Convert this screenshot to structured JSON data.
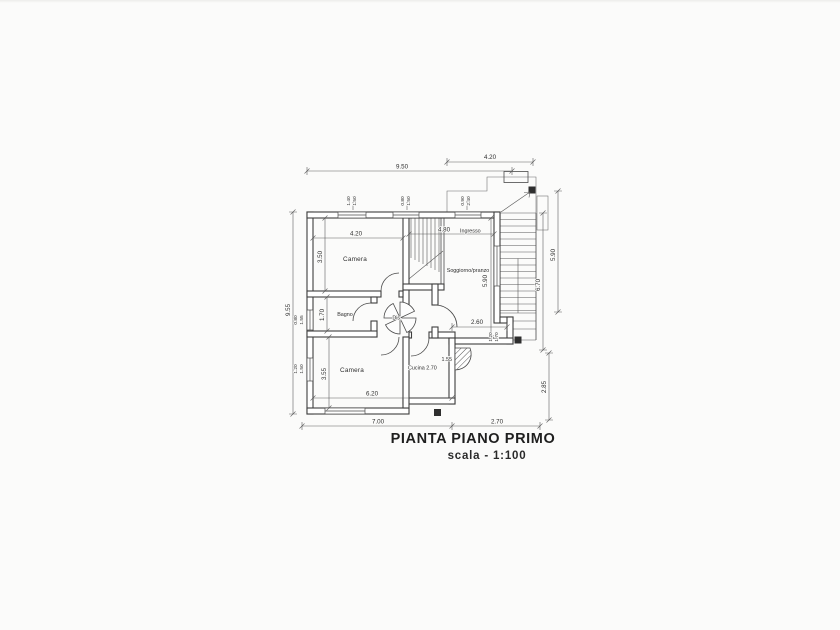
{
  "title": {
    "main": "PIANTA PIANO PRIMO",
    "scale_label": "scala  -  1:100"
  },
  "rooms": {
    "camera_top": "Camera",
    "soggiorno": "Soggiorno/pranzo",
    "ingresso": "Ingresso",
    "bagno": "Bagno",
    "disimpegno": "Dis.",
    "camera_bottom": "Camera",
    "cucina_label": "Cucina  2.70",
    "cucina_depth": "1.55"
  },
  "dims": {
    "top_landing": "4.20",
    "top_total": "9.50",
    "left_total": "9.55",
    "camera_top_width": "4.20",
    "camera_top_height": "3.50",
    "bagno_height": "1.70",
    "camera_bottom_height": "3.55",
    "camera_bottom_width": "6.20",
    "ingresso_width": "4.80",
    "soggiorno_height": "5.90",
    "stair_right_height": "5.90",
    "right_total_height": "6.70",
    "right_lower_height": "2.85",
    "bottom_left_width": "7.00",
    "bottom_right_width": "2.70",
    "terrace_width": "2.60",
    "win_top1_w": "1.40",
    "win_top1_h": "1.50",
    "win_top2_w": "0.80",
    "win_top2_h": "1.50",
    "win_top3_w": "0.90",
    "win_top3_h": "2.40",
    "win_left1_w": "0.80",
    "win_left1_h": "1.55",
    "win_left2_w": "1.20",
    "win_left2_h": "1.50",
    "win_right_w": "1.20",
    "win_right_h": "1.70"
  },
  "colors": {
    "paper": "#fbfbfa",
    "wall_line": "#3e3e3e",
    "dim_line": "#5f5f5f",
    "text": "#2f2f2f"
  }
}
